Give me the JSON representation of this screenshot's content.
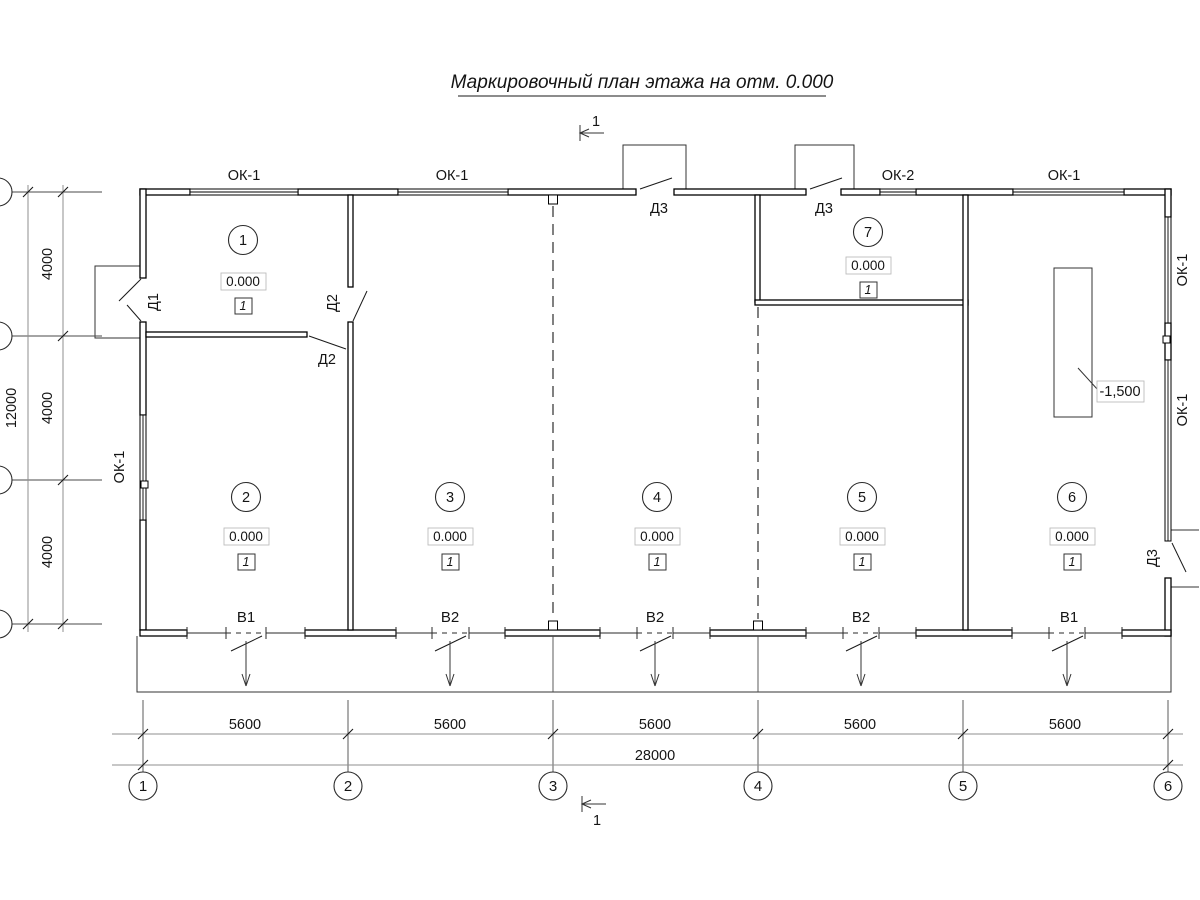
{
  "title": "Маркировочный план этажа на отм. 0.000",
  "section": {
    "number": "1"
  },
  "axes": [
    "1",
    "2",
    "3",
    "4",
    "5",
    "6"
  ],
  "rooms": [
    {
      "number": "1",
      "elevation": "0.000",
      "type": "1"
    },
    {
      "number": "2",
      "elevation": "0.000",
      "type": "1"
    },
    {
      "number": "3",
      "elevation": "0.000",
      "type": "1"
    },
    {
      "number": "4",
      "elevation": "0.000",
      "type": "1"
    },
    {
      "number": "5",
      "elevation": "0.000",
      "type": "1"
    },
    {
      "number": "6",
      "elevation": "0.000",
      "type": "1"
    },
    {
      "number": "7",
      "elevation": "0.000",
      "type": "1"
    }
  ],
  "windows": {
    "ok1": "ОК-1",
    "ok2": "ОК-2"
  },
  "doors": {
    "d1": "Д1",
    "d2": "Д2",
    "d3": "Д3"
  },
  "vents": {
    "v1": "В1",
    "v2": "В2"
  },
  "pit": {
    "elevation": "-1,500"
  },
  "dims": {
    "bay": "5600",
    "total": "28000",
    "row": "4000",
    "row_total": "12000"
  }
}
